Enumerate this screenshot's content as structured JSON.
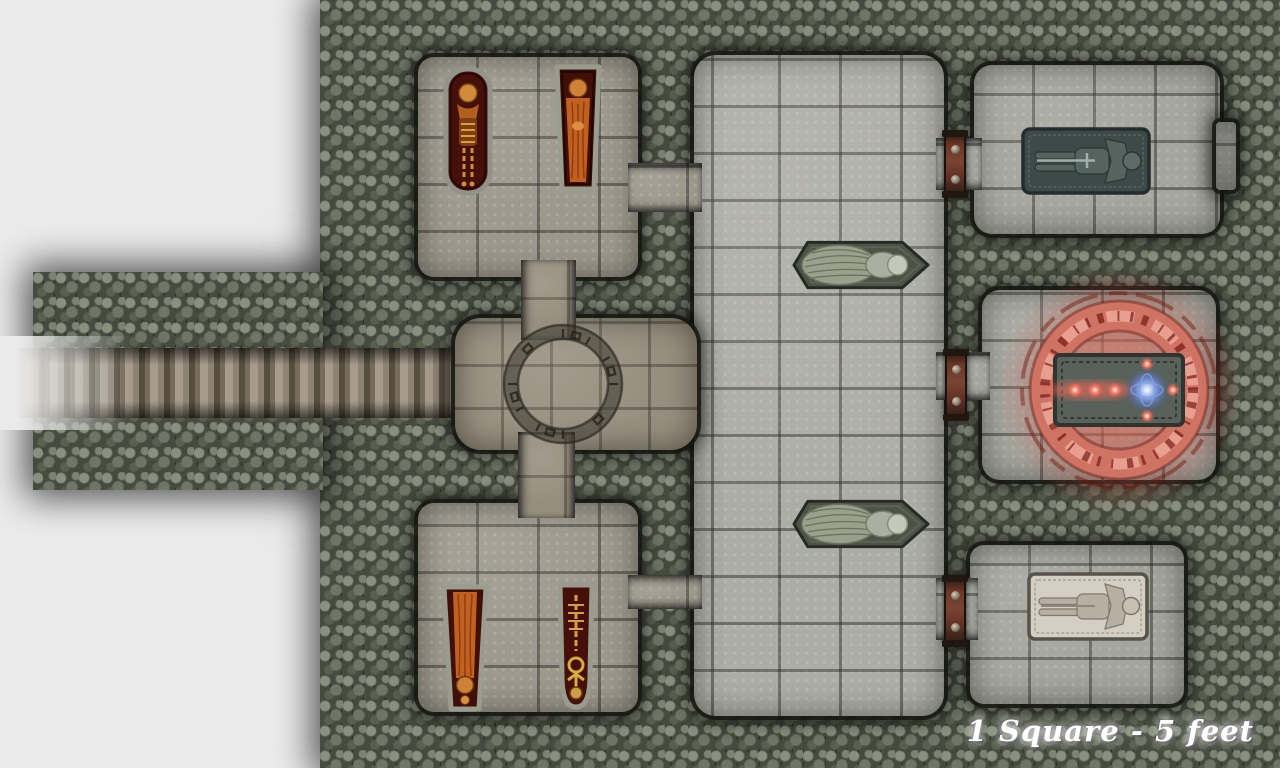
{
  "map": {
    "kind": "top-down dungeon crypt battle map",
    "scale_label": "1 Square - 5 feet",
    "areas": [
      {
        "id": "entrance-stairs-west",
        "contents": "long descending staircase entering from the west edge"
      },
      {
        "id": "rune-crossing",
        "contents": "circular chamber with an engraved rune circle at the corridor crossing"
      },
      {
        "id": "crypt-northwest",
        "contents": "two open sarcophagi holding orange-shrouded and skeletal remains"
      },
      {
        "id": "crypt-southwest",
        "contents": "two open sarcophagi holding orange-shrouded and skeletal remains"
      },
      {
        "id": "great-hall-center",
        "contents": "long flagstone hall with two winged stone statues on plinths"
      },
      {
        "id": "tomb-northeast",
        "contents": "dark green stone sarcophagus lid carved with a sword-bearing effigy"
      },
      {
        "id": "ritual-chamber-east",
        "contents": "glowing red summoning circle around an altar slab with three red orbs and one blue orb"
      },
      {
        "id": "tomb-southeast",
        "contents": "pale stone sarcophagus lid carved with a robed effigy"
      }
    ],
    "doors": {
      "count": 3,
      "style": "iron-banded rust doors on the east wall of the hall"
    },
    "colors": {
      "offmap_background": "#ebebeb",
      "cave_wall": "#474b3f",
      "wall_stone_light": "#8a907f",
      "floor_grey": "#a4a59d",
      "floor_tan": "#968e7e",
      "coffin_interior": "#46100a",
      "body_orange": "#c2611f",
      "bone_gold": "#d8a03c",
      "effigy_dark": "#3e4a47",
      "effigy_pale": "#d5cfc3",
      "ritual_red": "#d4766a",
      "rune_dark_red": "#6e120c",
      "orb_blue": "#7e9ce0",
      "door_rust": "#7a4434",
      "statue_stone": "#99a08c",
      "label_text": "#ffffff"
    }
  }
}
